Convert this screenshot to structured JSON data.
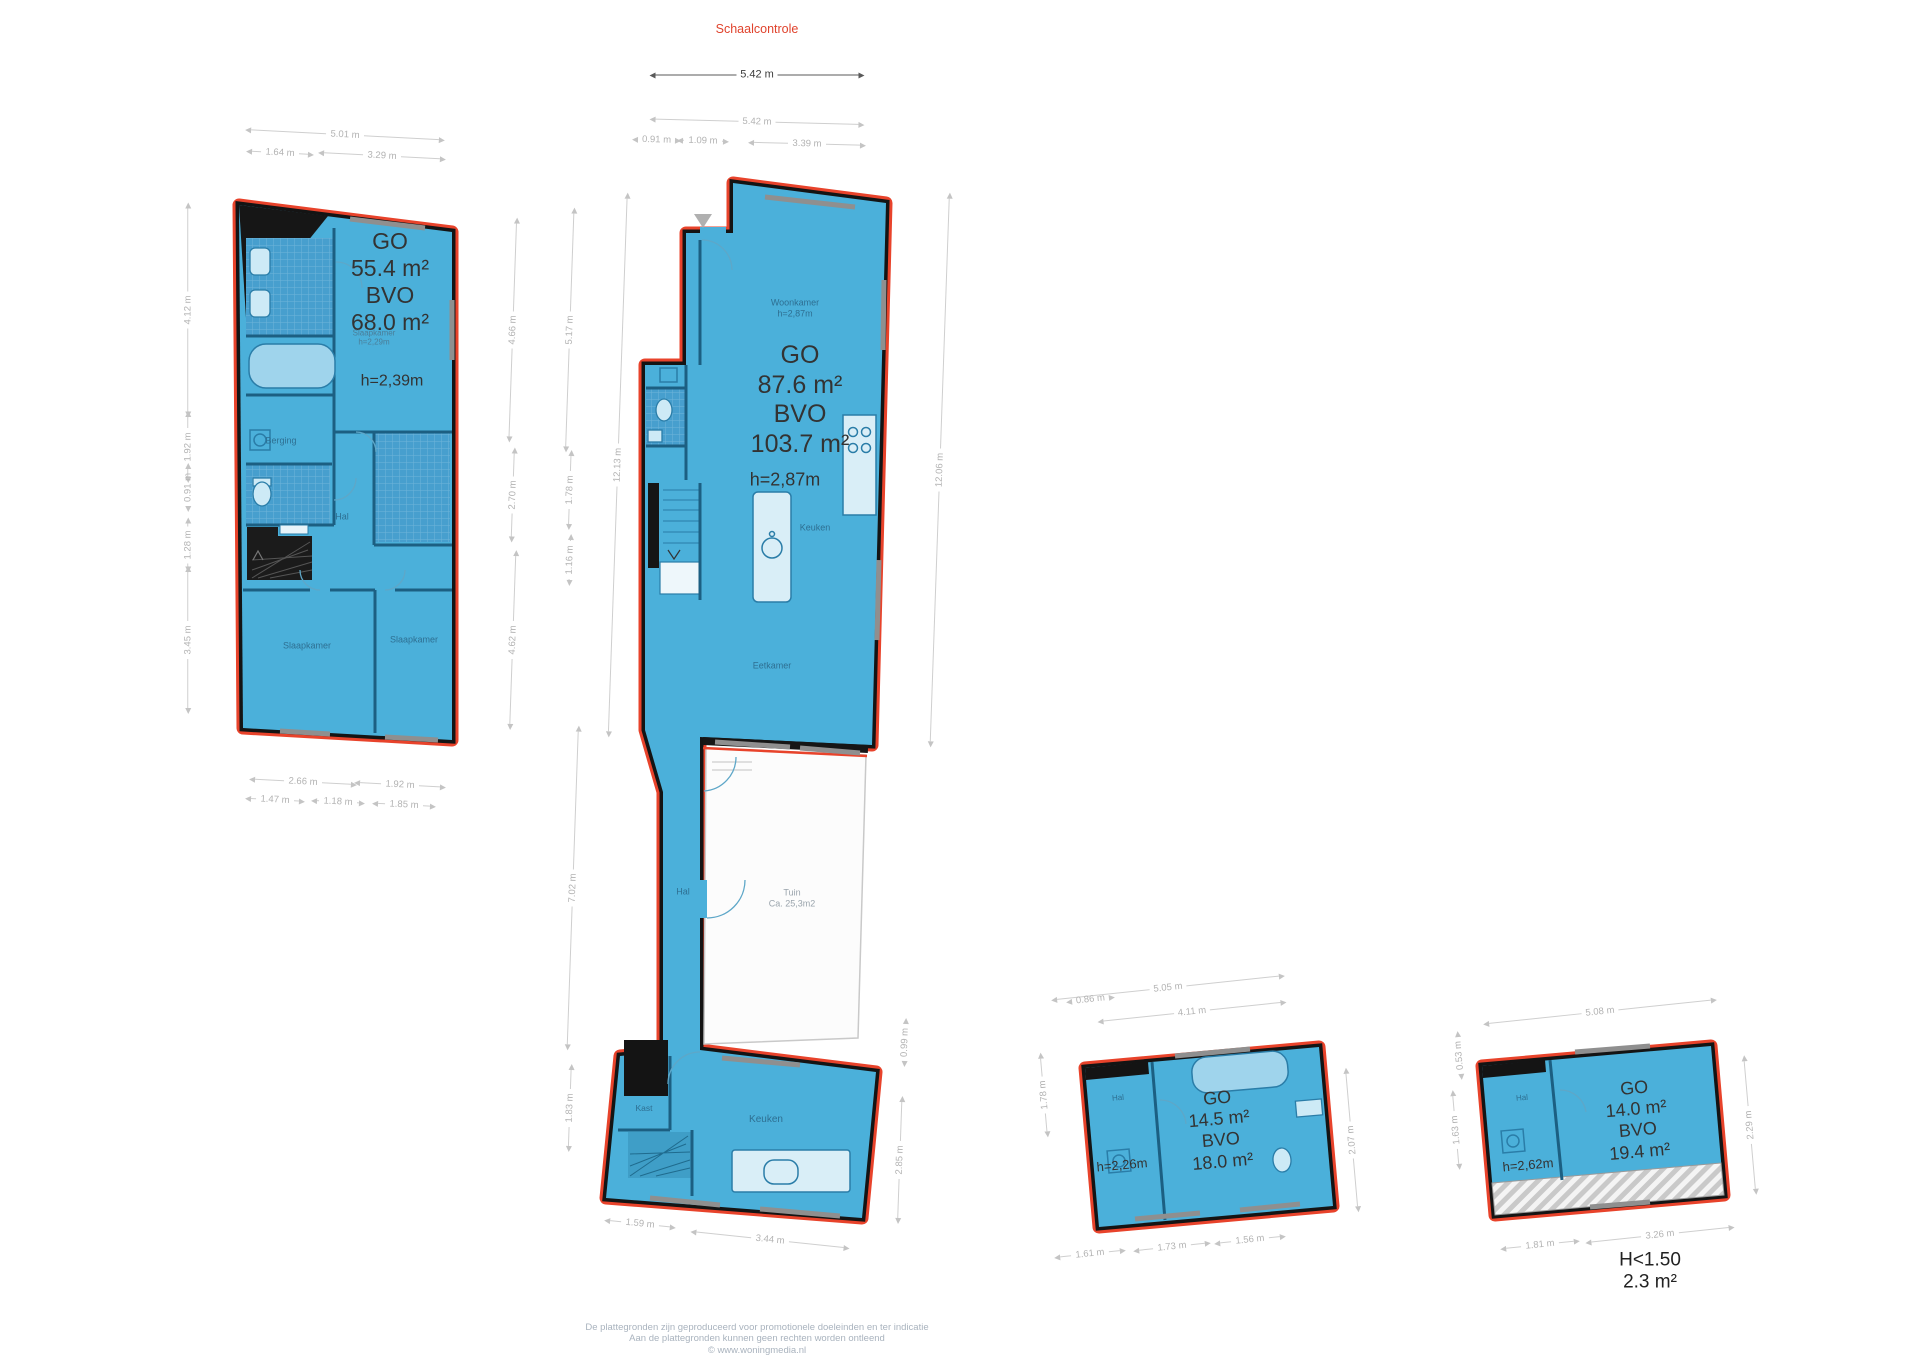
{
  "scale_check": {
    "label": "Schaalcontrole",
    "distance": "5.42 m"
  },
  "colors": {
    "floor_fill": "#4bb0da",
    "outline_red": "#e8432b",
    "wall_black": "#141414",
    "dim_gray": "#b3b3b3",
    "text_dark": "#333333",
    "room_label_blue": "#2e6f92",
    "footer_gray": "#a9b3be"
  },
  "floor_plans": [
    {
      "id": "plan-1",
      "go_label": "GO",
      "go": "55.4 m²",
      "bvo_label": "BVO",
      "bvo": "68.0 m²",
      "height": "h=2,39m",
      "room_note": "Slaapkamer h=2,29m",
      "rooms": [
        "Berging",
        "Hal",
        "Slaapkamer",
        "Slaapkamer"
      ]
    },
    {
      "id": "plan-2",
      "go_label": "GO",
      "go": "87.6 m²",
      "bvo_label": "BVO",
      "bvo": "103.7 m²",
      "height": "h=2,87m",
      "rooms": [
        "Woonkamer",
        "Hal",
        "Keuken",
        "Eetkamer",
        "Hal",
        "Kast",
        "Keuken"
      ],
      "garden": {
        "name": "Tuin",
        "area": "Ca. 25,3m2"
      }
    },
    {
      "id": "plan-3",
      "go_label": "GO",
      "go": "14.5 m²",
      "bvo_label": "BVO",
      "bvo": "18.0 m²",
      "height": "h=2,26m",
      "rooms": [
        "Hal"
      ]
    },
    {
      "id": "plan-4",
      "go_label": "GO",
      "go": "14.0 m²",
      "bvo_label": "BVO",
      "bvo": "19.4 m²",
      "height": "h=2,62m",
      "rooms": [
        "Hal"
      ],
      "low_height": {
        "label": "H<1.50",
        "area": "2.3 m²"
      }
    }
  ],
  "labels": [
    {
      "name": "plan1-area-label",
      "text": "GO\n55.4 m²\nBVO\n68.0 m²",
      "x": 390,
      "y": 282,
      "fs": 23,
      "color": "#333333"
    },
    {
      "name": "plan1-room-note",
      "text": "Slaapkamer\nh=2,29m",
      "x": 374,
      "y": 338,
      "fs": 8,
      "color": "#4a7e99"
    },
    {
      "name": "plan1-height-label",
      "text": "h=2,39m",
      "x": 392,
      "y": 382,
      "fs": 16,
      "color": "#333333"
    },
    {
      "name": "room-label-berging",
      "text": "Berging",
      "x": 281,
      "y": 441,
      "fs": 9,
      "color": "#2e6f92"
    },
    {
      "name": "room-label-hal-1",
      "text": "Hal",
      "x": 342,
      "y": 517,
      "fs": 9,
      "color": "#2e6f92"
    },
    {
      "name": "room-label-slaapkamer-1",
      "text": "Slaapkamer",
      "x": 307,
      "y": 646,
      "fs": 9,
      "color": "#2e6f92"
    },
    {
      "name": "room-label-slaapkamer-2",
      "text": "Slaapkamer",
      "x": 414,
      "y": 640,
      "fs": 9,
      "color": "#2e6f92"
    },
    {
      "name": "room-label-woonkamer",
      "text": "Woonkamer\nh=2,87m",
      "x": 795,
      "y": 308,
      "fs": 9,
      "color": "#2e6f92"
    },
    {
      "name": "plan2-area-label",
      "text": "GO\n87.6 m²\nBVO\n103.7 m²",
      "x": 800,
      "y": 400,
      "fs": 25,
      "color": "#333333"
    },
    {
      "name": "plan2-height-label",
      "text": "h=2,87m",
      "x": 785,
      "y": 480,
      "fs": 18,
      "color": "#333333"
    },
    {
      "name": "room-label-keuken-1",
      "text": "Keuken",
      "x": 815,
      "y": 528,
      "fs": 9,
      "color": "#2e6f92"
    },
    {
      "name": "room-label-eetkamer",
      "text": "Eetkamer",
      "x": 772,
      "y": 666,
      "fs": 9,
      "color": "#2e6f92"
    },
    {
      "name": "room-label-hal-2",
      "text": "Hal",
      "x": 683,
      "y": 892,
      "fs": 9,
      "color": "#2e6f92"
    },
    {
      "name": "garden-label",
      "text": "Tuin\nCa. 25,3m2",
      "x": 792,
      "y": 898,
      "fs": 9,
      "color": "#9aa4ac"
    },
    {
      "name": "room-label-kast",
      "text": "Kast",
      "x": 644,
      "y": 1108,
      "fs": 8.5,
      "color": "#2e6f92"
    },
    {
      "name": "room-label-keuken-2",
      "text": "Keuken",
      "x": 766,
      "y": 1120,
      "fs": 10,
      "color": "#2e6f92"
    },
    {
      "name": "plan3-area-label",
      "text": "GO\n14.5 m²\nBVO\n18.0 m²",
      "x": 1220,
      "y": 1130,
      "fs": 18,
      "color": "#333333",
      "rot": -5
    },
    {
      "name": "plan3-height-label",
      "text": "h=2,26m",
      "x": 1122,
      "y": 1165,
      "fs": 13,
      "color": "#333333",
      "rot": -5
    },
    {
      "name": "room-label-hal-3",
      "text": "Hal",
      "x": 1118,
      "y": 1098,
      "fs": 8,
      "color": "#2e6f92",
      "rot": -5
    },
    {
      "name": "plan4-area-label",
      "text": "GO\n14.0 m²\nBVO\n19.4 m²",
      "x": 1637,
      "y": 1120,
      "fs": 18,
      "color": "#333333",
      "rot": -5
    },
    {
      "name": "plan4-height-label",
      "text": "h=2,62m",
      "x": 1528,
      "y": 1165,
      "fs": 13,
      "color": "#333333",
      "rot": -5
    },
    {
      "name": "room-label-hal-4",
      "text": "Hal",
      "x": 1522,
      "y": 1098,
      "fs": 8,
      "color": "#2e6f92",
      "rot": -5
    },
    {
      "name": "low-height-label",
      "text": "H<1.50\n2.3 m²",
      "x": 1650,
      "y": 1272,
      "fs": 19,
      "color": "#222222"
    }
  ],
  "dimensions": [
    {
      "name": "scale-bar",
      "label": "5.42 m",
      "x": 757,
      "y": 75,
      "w": 215,
      "rot": 0,
      "dark": true
    },
    {
      "label": "5.01 m",
      "x": 345,
      "y": 135,
      "w": 200,
      "rot": 3
    },
    {
      "label": "1.64 m",
      "x": 280,
      "y": 153,
      "w": 68,
      "rot": 3
    },
    {
      "label": "3.29 m",
      "x": 382,
      "y": 156,
      "w": 128,
      "rot": 3
    },
    {
      "label": "4.12 m",
      "x": 188,
      "y": 310,
      "w": 215,
      "rot": -90
    },
    {
      "label": "1.92 m",
      "x": 188,
      "y": 447,
      "w": 72,
      "rot": -90
    },
    {
      "label": "0.91 m",
      "x": 188,
      "y": 492,
      "w": 40,
      "rot": -90
    },
    {
      "label": "1.28 m",
      "x": 188,
      "y": 545,
      "w": 55,
      "rot": -90
    },
    {
      "label": "3.45 m",
      "x": 188,
      "y": 640,
      "w": 148,
      "rot": -90
    },
    {
      "label": "4.66 m",
      "x": 513,
      "y": 330,
      "w": 225,
      "rot": -88
    },
    {
      "label": "2.70 m",
      "x": 513,
      "y": 495,
      "w": 95,
      "rot": -88
    },
    {
      "label": "4.62 m",
      "x": 513,
      "y": 640,
      "w": 180,
      "rot": -88
    },
    {
      "label": "2.66 m",
      "x": 303,
      "y": 782,
      "w": 108,
      "rot": 3
    },
    {
      "label": "1.92 m",
      "x": 400,
      "y": 785,
      "w": 92,
      "rot": 3
    },
    {
      "label": "1.47 m",
      "x": 275,
      "y": 800,
      "w": 60,
      "rot": 3
    },
    {
      "label": "1.18 m",
      "x": 338,
      "y": 802,
      "w": 54,
      "rot": 3
    },
    {
      "label": "1.85 m",
      "x": 404,
      "y": 805,
      "w": 64,
      "rot": 3
    },
    {
      "label": "5.42 m",
      "x": 757,
      "y": 122,
      "w": 215,
      "rot": 1.5
    },
    {
      "label": "0.91 m",
      "x": 654,
      "y": 140,
      "w": 44,
      "rot": 1.5
    },
    {
      "label": "1.09 m",
      "x": 703,
      "y": 141,
      "w": 52,
      "rot": 1.5
    },
    {
      "label": "3.39 m",
      "x": 807,
      "y": 144,
      "w": 118,
      "rot": 1.5
    },
    {
      "label": "5.17 m",
      "x": 570,
      "y": 330,
      "w": 245,
      "rot": -88
    },
    {
      "label": "1.78 m",
      "x": 570,
      "y": 490,
      "w": 80,
      "rot": -88
    },
    {
      "label": "1.16 m",
      "x": 570,
      "y": 560,
      "w": 52,
      "rot": -88
    },
    {
      "label": "12.13 m",
      "x": 618,
      "y": 465,
      "w": 545,
      "rot": -88
    },
    {
      "label": "7.02 m",
      "x": 573,
      "y": 888,
      "w": 325,
      "rot": -88
    },
    {
      "label": "1.83 m",
      "x": 570,
      "y": 1108,
      "w": 88,
      "rot": -88
    },
    {
      "label": "12.06 m",
      "x": 940,
      "y": 470,
      "w": 555,
      "rot": -88
    },
    {
      "label": "0.99 m",
      "x": 905,
      "y": 1043,
      "w": 48,
      "rot": -88
    },
    {
      "label": "2.85 m",
      "x": 900,
      "y": 1160,
      "w": 128,
      "rot": -88
    },
    {
      "label": "1.59 m",
      "x": 640,
      "y": 1224,
      "w": 72,
      "rot": 6
    },
    {
      "label": "3.44 m",
      "x": 770,
      "y": 1240,
      "w": 160,
      "rot": 6
    },
    {
      "label": "5.05 m",
      "x": 1168,
      "y": 988,
      "w": 235,
      "rot": -6
    },
    {
      "label": "0.86 m",
      "x": 1087,
      "y": 1000,
      "w": 42,
      "rot": -6
    },
    {
      "label": "4.11 m",
      "x": 1192,
      "y": 1012,
      "w": 190,
      "rot": -6
    },
    {
      "label": "1.78 m",
      "x": 1044,
      "y": 1095,
      "w": 85,
      "rot": -95
    },
    {
      "label": "2.07 m",
      "x": 1352,
      "y": 1140,
      "w": 145,
      "rot": -95
    },
    {
      "label": "1.61 m",
      "x": 1090,
      "y": 1254,
      "w": 72,
      "rot": -6
    },
    {
      "label": "1.73 m",
      "x": 1172,
      "y": 1247,
      "w": 78,
      "rot": -6
    },
    {
      "label": "1.56 m",
      "x": 1250,
      "y": 1240,
      "w": 72,
      "rot": -6
    },
    {
      "label": "5.08 m",
      "x": 1600,
      "y": 1012,
      "w": 235,
      "rot": -6
    },
    {
      "label": "0.53 m",
      "x": 1460,
      "y": 1062,
      "w": 36,
      "rot": -95
    },
    {
      "label": "1.63 m",
      "x": 1456,
      "y": 1130,
      "w": 80,
      "rot": -95
    },
    {
      "label": "2.29 m",
      "x": 1750,
      "y": 1125,
      "w": 140,
      "rot": -95
    },
    {
      "label": "1.81 m",
      "x": 1540,
      "y": 1245,
      "w": 80,
      "rot": -6
    },
    {
      "label": "3.26 m",
      "x": 1660,
      "y": 1235,
      "w": 150,
      "rot": -6
    }
  ],
  "footer": {
    "lines": [
      "De plattegronden zijn geproduceerd voor promotionele doeleinden en ter indicatie",
      "Aan de plattegronden kunnen geen rechten worden ontleend",
      "© www.woningmedia.nl"
    ]
  }
}
